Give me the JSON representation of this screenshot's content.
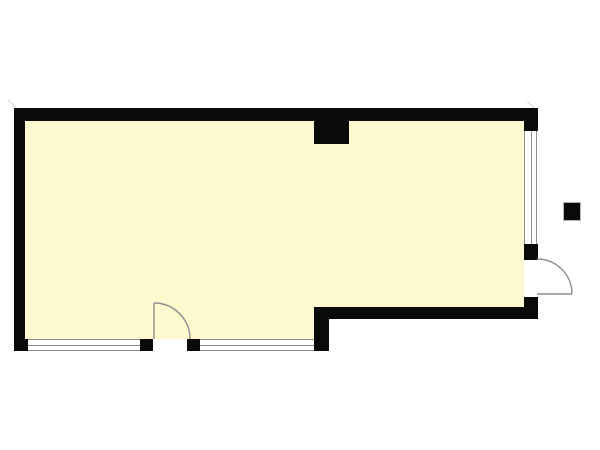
{
  "meta": {
    "type": "floor-plan",
    "description": "Black-and-white architectural floor plan of a single L-shaped room with pale yellow floor fill, two hinged doors with quarter-circle swing arcs, three sash windows, one interior column on the top wall and one small detached square post outside the right wall"
  },
  "colors": {
    "background": "#ffffff",
    "floor": "#fbf9cd",
    "wall": "#0a0a0a",
    "window_line": "#8d8d8d",
    "door_line": "#8f8f8f",
    "post_outline": "#b5b5b5",
    "artifact": "#c9c9c9"
  },
  "room": {
    "name": "main-room",
    "shape": "L-shaped",
    "fill": "#fbf9cd"
  },
  "features": {
    "doors": [
      {
        "id": "bottom-door",
        "wall": "bottom-left",
        "hinge": "left",
        "swing": "inward quarter-circle"
      },
      {
        "id": "right-door",
        "wall": "right",
        "hinge": "bottom",
        "swing": "outward quarter-circle"
      }
    ],
    "windows": [
      {
        "id": "bottom-window-left",
        "wall": "bottom-left",
        "panes": 2
      },
      {
        "id": "bottom-window-right",
        "wall": "bottom-left",
        "panes": 2
      },
      {
        "id": "right-window",
        "wall": "right",
        "panes": 2
      }
    ],
    "column": {
      "id": "top-wall-column",
      "shape": "square",
      "attached_to": "top wall, inside"
    },
    "detached_post": {
      "id": "outside-post",
      "shape": "square",
      "location": "outside right wall"
    }
  },
  "door_geometry": {
    "bottom_door": {
      "leaf": "M154,339 L154,303",
      "arc": "M154,303 A36,36 0 0 1 190,339"
    },
    "right_door": {
      "leaf": "M537,294 L572,294",
      "arc": "M537,259 A35,35 0 0 1 572,294"
    }
  }
}
